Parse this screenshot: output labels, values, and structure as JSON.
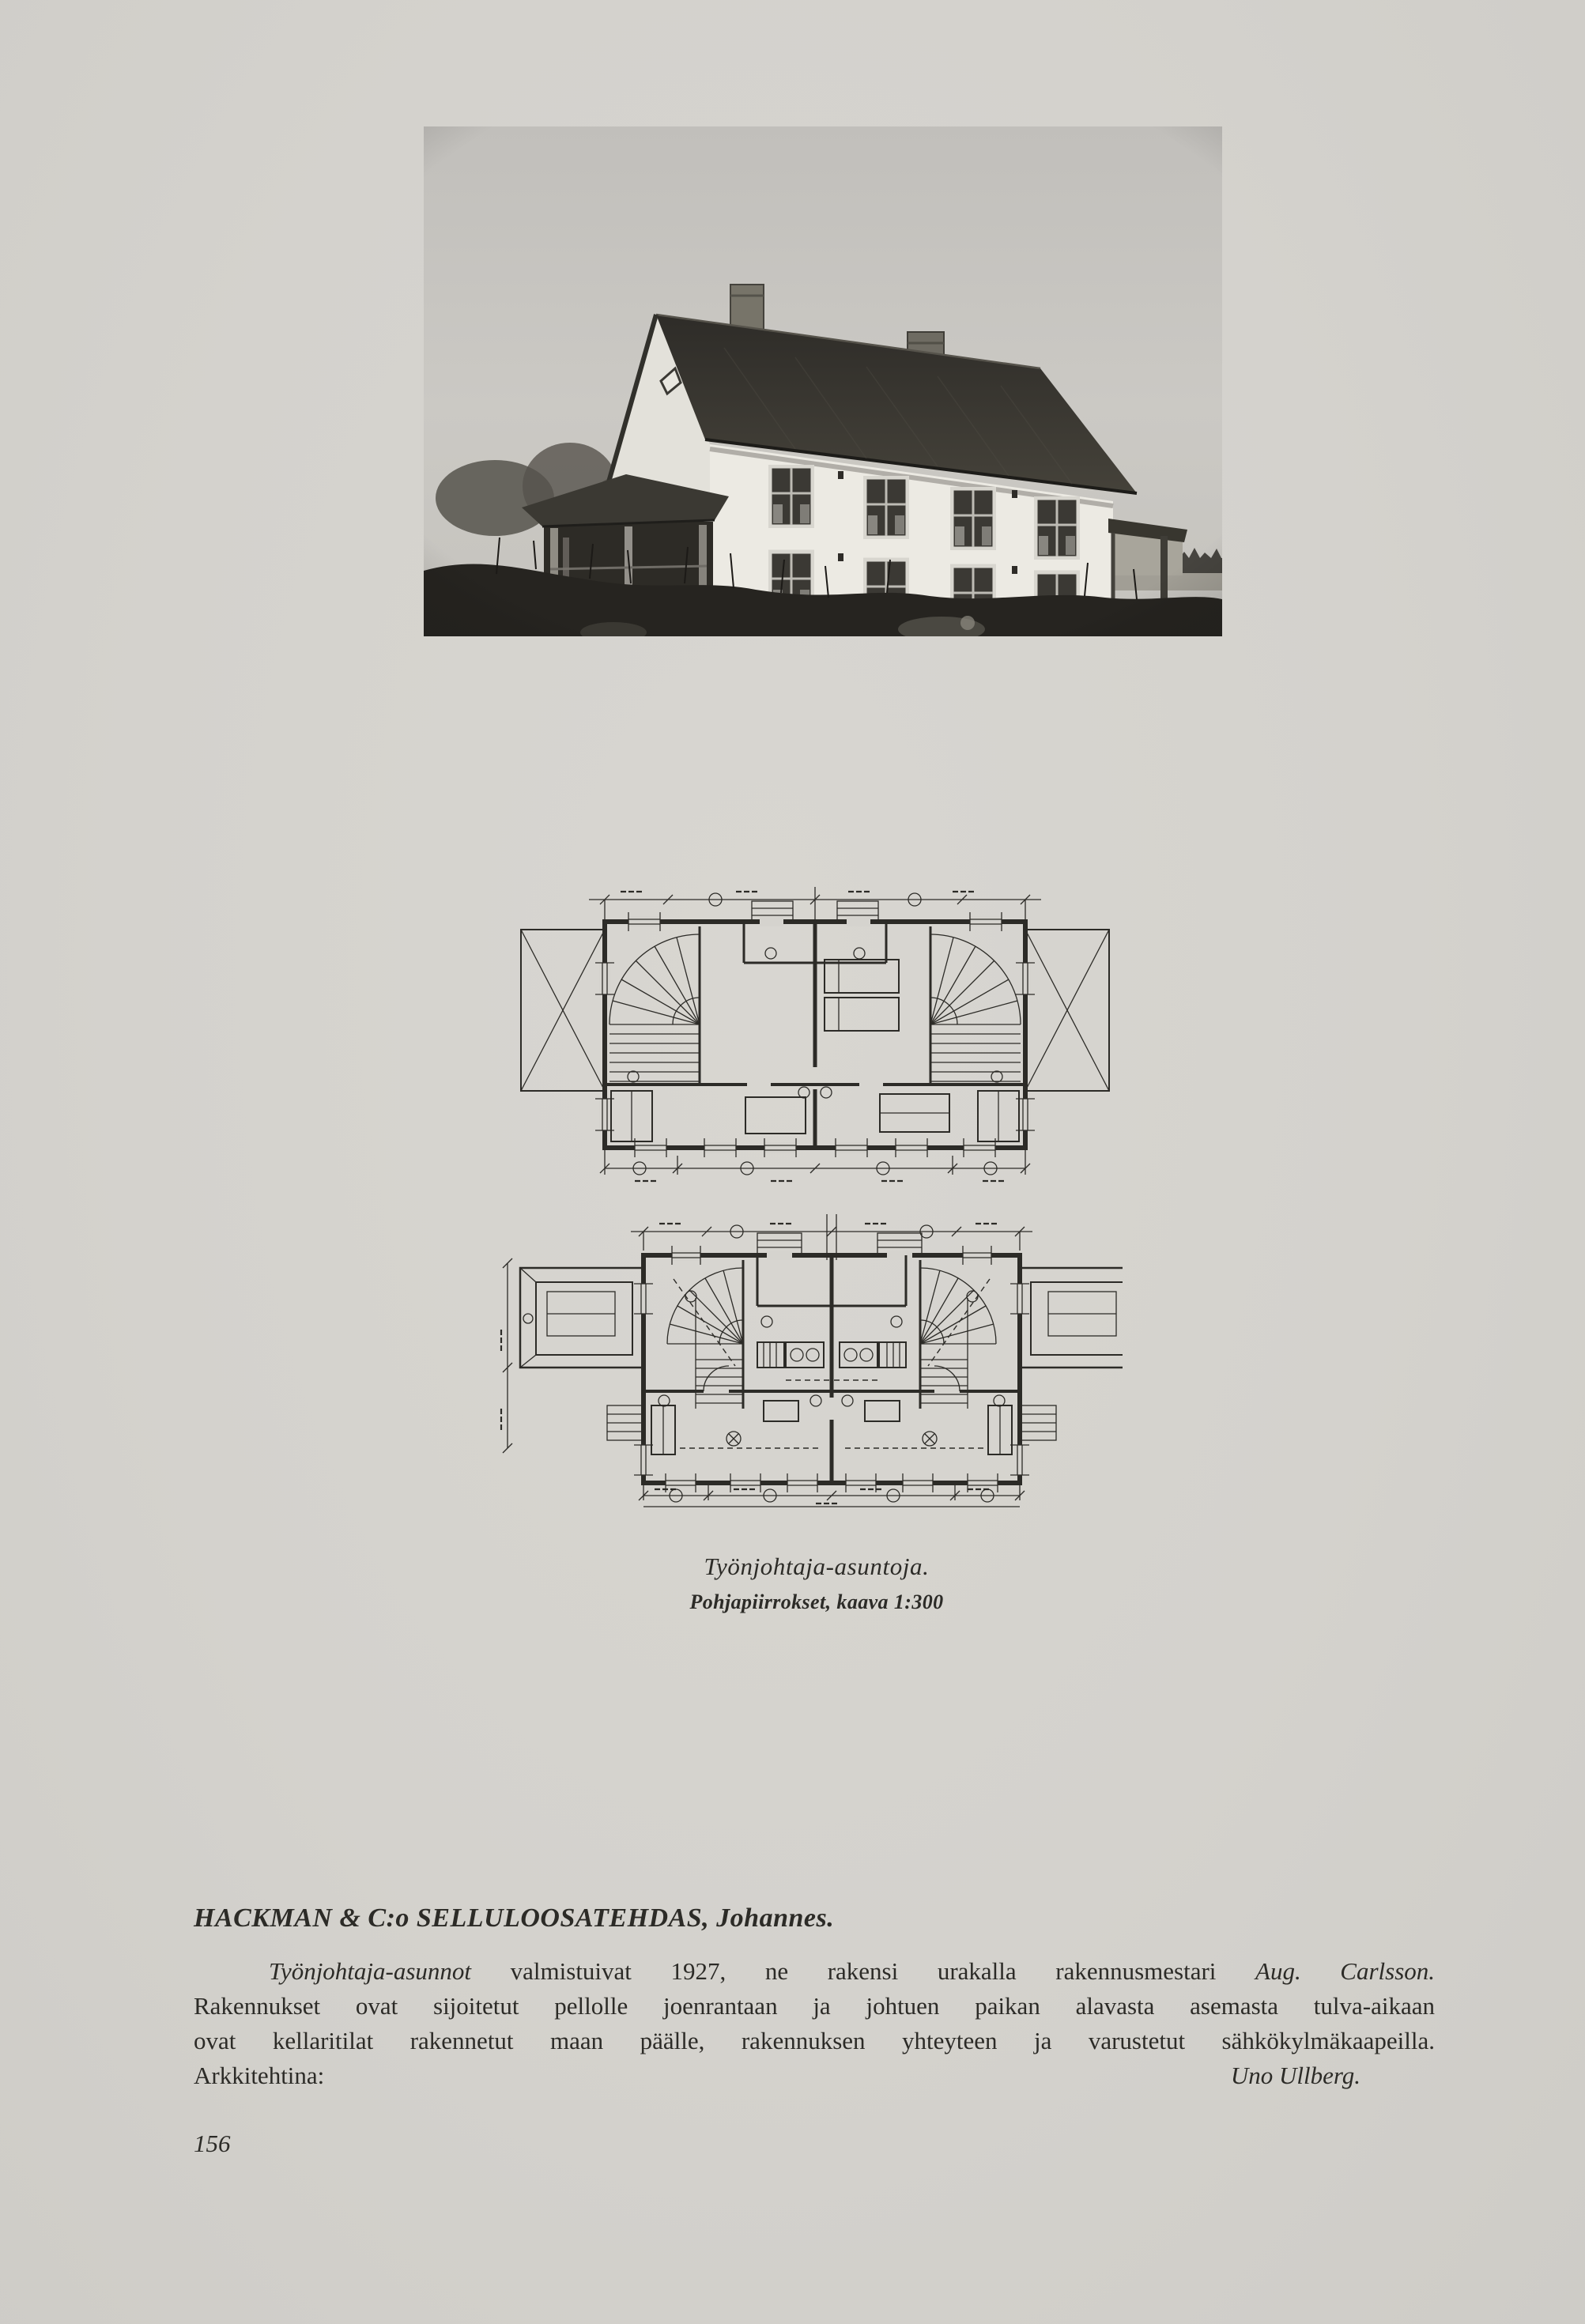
{
  "caption": {
    "title": "Työnjohtaja-asuntoja.",
    "subtitle": "Pohjapiirrokset, kaava 1:300"
  },
  "article": {
    "heading": "HACKMAN & C:o SELLULOOSATEHDAS, Johannes.",
    "line1_lead_italic": "Työnjohtaja-asunnot",
    "line1_middle": "valmistuivat 1927, ne rakensi urakalla rakennusmestari",
    "line1_name_italic": "Aug. Carlsson.",
    "line2": "Rakennukset ovat sijoitetut pellolle joenrantaan ja johtuen paikan alavasta asemasta tulva-aikaan",
    "line3": "ovat kellaritilat rakennetut maan päälle, rakennuksen yhteyteen ja varustetut sähkökylmäkaapeilla.",
    "line4_label": "Arkkitehtina:",
    "line4_name": "Uno Ullberg."
  },
  "page_number": "156",
  "figures": {
    "photo_alt": "Työnjohtaja-asuinrakennus, valokuva",
    "plan_upper_alt": "Pohjapiirros, yläkerta",
    "plan_lower_alt": "Pohjapiirros, alakerta"
  },
  "colors": {
    "paper": "#d5d3ce",
    "ink": "#2c2b27",
    "photo_sky": "#c7c5c0",
    "roof": "#33312d",
    "wall_white": "#eceae3",
    "foreground_dark": "#262420"
  }
}
